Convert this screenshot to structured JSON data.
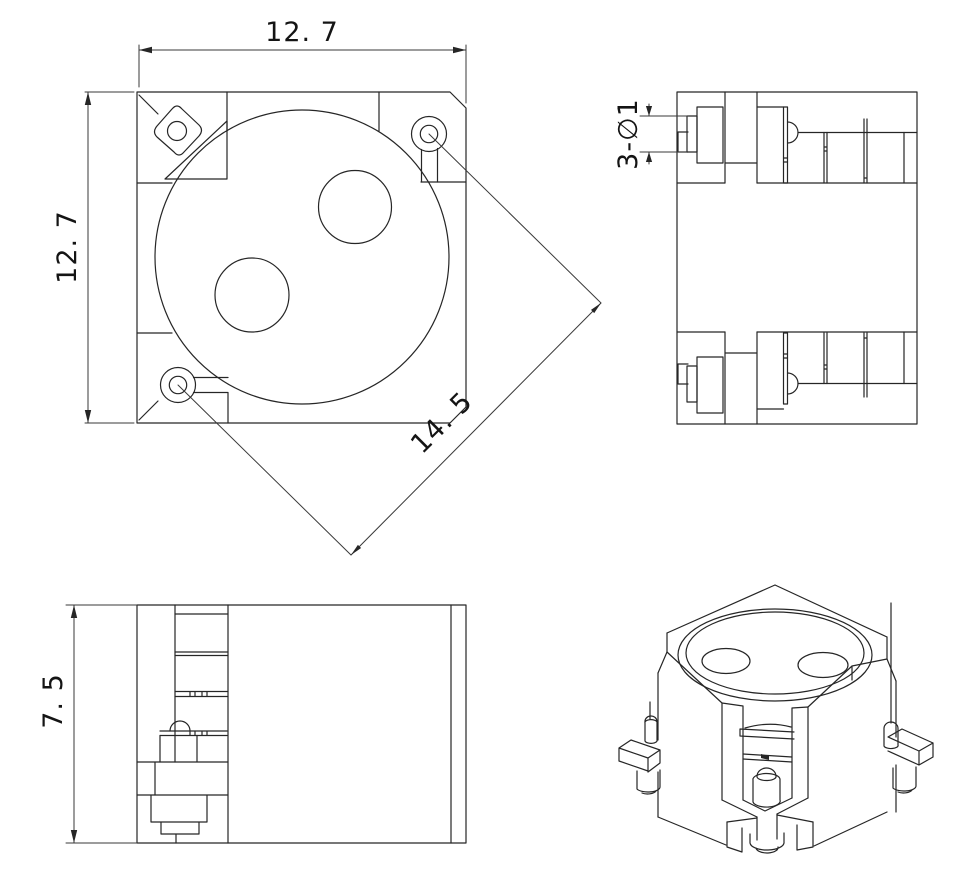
{
  "document": {
    "type": "engineering-drawing",
    "background": "#ffffff",
    "line_color": "#262626",
    "dimension_line_color": "#3a3a3a",
    "text_color": "#141414"
  },
  "dimensions": {
    "top_width": "12. 7",
    "left_height": "12. 7",
    "diagonal_holes": "14. 5",
    "pin_diameter": "3-∅1",
    "front_height": "7. 5"
  }
}
